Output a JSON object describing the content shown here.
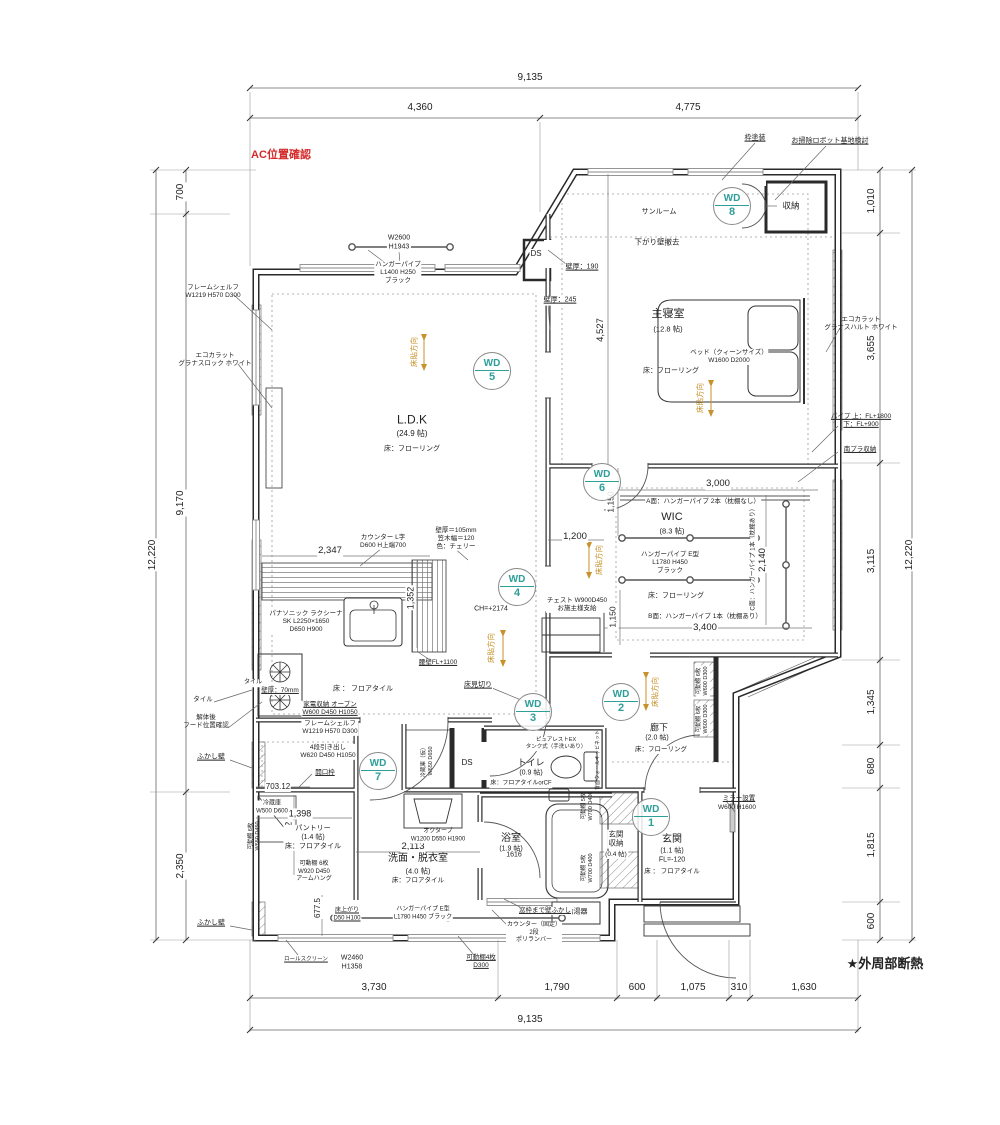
{
  "colors": {
    "red": "#d42a2a",
    "orange": "#c8922a",
    "teal": "#2e9e99",
    "line": "#2a2a2a"
  },
  "notes": {
    "ac_check": "AC位置確認",
    "insulation": "★外周部断熱"
  },
  "rooms": [
    {
      "name": "LDK",
      "label": "L.D.K",
      "size": "(24.9 帖)",
      "floor": "床：フローリング"
    },
    {
      "name": "主寝室",
      "label": "主寝室",
      "size": "(12.8 帖)",
      "floor": "床：フローリング"
    },
    {
      "name": "WIC",
      "label": "WIC",
      "size": "(8.3 帖)",
      "floor": "床：フローリング"
    },
    {
      "name": "廊下",
      "label": "廊下",
      "size": "(2.0 帖)",
      "floor": "床：フローリング"
    },
    {
      "name": "トイレ",
      "label": "トイレ",
      "size": "(0.9 帖)",
      "floor": "床：フロアタイルorCF"
    },
    {
      "name": "浴室",
      "label": "浴室",
      "size": "(1.9 帖)",
      "floor": "1616"
    },
    {
      "name": "洗面・脱衣室",
      "label": "洗面・脱衣室",
      "size": "(4.0 帖)",
      "floor": "床：フロアタイル"
    },
    {
      "name": "パントリー",
      "label": "パントリー",
      "size": "(1.4 帖)",
      "floor": "床：フロアタイル"
    },
    {
      "name": "玄関",
      "label": "玄関",
      "size": "(1.1 帖)",
      "floor": "床：フロアタイル"
    },
    {
      "name": "玄関収納",
      "label": "玄関収納",
      "size": "(0.4 帖)"
    },
    {
      "name": "サンルーム",
      "label": "サンルーム"
    }
  ],
  "wd_markers": [
    {
      "n": "wd-1",
      "label": "WD",
      "num": "1",
      "x": 651,
      "y": 817
    },
    {
      "n": "wd-2",
      "label": "WD",
      "num": "2",
      "x": 621,
      "y": 702
    },
    {
      "n": "wd-3",
      "label": "WD",
      "num": "3",
      "x": 533,
      "y": 712
    },
    {
      "n": "wd-4",
      "label": "WD",
      "num": "4",
      "x": 517,
      "y": 587
    },
    {
      "n": "wd-5",
      "label": "WD",
      "num": "5",
      "x": 492,
      "y": 371
    },
    {
      "n": "wd-6",
      "label": "WD",
      "num": "6",
      "x": 602,
      "y": 482
    },
    {
      "n": "wd-7",
      "label": "WD",
      "num": "7",
      "x": 378,
      "y": 771
    },
    {
      "n": "wd-8",
      "label": "WD",
      "num": "8",
      "x": 732,
      "y": 206
    }
  ],
  "labels": [
    {
      "n": "note-ac-check",
      "t": "AC位置確認",
      "x": 281,
      "y": 156,
      "s": 11,
      "c": "r",
      "w": 1
    },
    {
      "n": "note-insulation",
      "t": "★外周部断熱",
      "x": 885,
      "y": 964,
      "s": 13,
      "w": 1
    },
    {
      "n": "dim-top-total",
      "t": "9,135",
      "x": 530,
      "y": 78,
      "s": 10,
      "bg": 1
    },
    {
      "n": "dim-top-left",
      "t": "4,360",
      "x": 420,
      "y": 108,
      "s": 10,
      "bg": 1
    },
    {
      "n": "dim-top-right",
      "t": "4,775",
      "x": 688,
      "y": 108,
      "s": 10,
      "bg": 1
    },
    {
      "n": "dim-bottom-1",
      "t": "3,730",
      "x": 374,
      "y": 988,
      "s": 10,
      "bg": 1
    },
    {
      "n": "dim-bottom-2",
      "t": "1,790",
      "x": 557,
      "y": 988,
      "s": 10,
      "bg": 1
    },
    {
      "n": "dim-bottom-3",
      "t": "600",
      "x": 637,
      "y": 988,
      "s": 10,
      "bg": 1
    },
    {
      "n": "dim-bottom-4",
      "t": "1,075",
      "x": 693,
      "y": 988,
      "s": 10,
      "bg": 1
    },
    {
      "n": "dim-bottom-5",
      "t": "310",
      "x": 739,
      "y": 988,
      "s": 10,
      "bg": 1
    },
    {
      "n": "dim-bottom-6",
      "t": "1,630",
      "x": 804,
      "y": 988,
      "s": 10,
      "bg": 1
    },
    {
      "n": "dim-bottom-total",
      "t": "9,135",
      "x": 530,
      "y": 1020,
      "s": 10,
      "bg": 1
    },
    {
      "n": "dim-left-700",
      "t": "700",
      "x": 181,
      "y": 192,
      "s": 10,
      "r": -90,
      "bg": 1
    },
    {
      "n": "dim-left-9170",
      "t": "9,170",
      "x": 181,
      "y": 503,
      "s": 10,
      "r": -90,
      "bg": 1
    },
    {
      "n": "dim-left-2350",
      "t": "2,350",
      "x": 181,
      "y": 866,
      "s": 10,
      "r": -90,
      "bg": 1
    },
    {
      "n": "dim-left-total",
      "t": "12,220",
      "x": 153,
      "y": 555,
      "s": 10,
      "r": -90,
      "bg": 1
    },
    {
      "n": "dim-right-1010",
      "t": "1,010",
      "x": 872,
      "y": 201,
      "s": 10,
      "r": -90,
      "bg": 1
    },
    {
      "n": "dim-right-3655",
      "t": "3,655",
      "x": 872,
      "y": 348,
      "s": 10,
      "r": -90,
      "bg": 1
    },
    {
      "n": "dim-right-3115",
      "t": "3,115",
      "x": 872,
      "y": 561,
      "s": 10,
      "r": -90,
      "bg": 1
    },
    {
      "n": "dim-right-1345",
      "t": "1,345",
      "x": 872,
      "y": 702,
      "s": 10,
      "r": -90,
      "bg": 1
    },
    {
      "n": "dim-right-680",
      "t": "680",
      "x": 872,
      "y": 766,
      "s": 10,
      "r": -90,
      "bg": 1
    },
    {
      "n": "dim-right-1815",
      "t": "1,815",
      "x": 872,
      "y": 845,
      "s": 10,
      "r": -90,
      "bg": 1
    },
    {
      "n": "dim-right-600",
      "t": "600",
      "x": 872,
      "y": 921,
      "s": 10,
      "r": -90,
      "bg": 1
    },
    {
      "n": "dim-right-total",
      "t": "12,220",
      "x": 910,
      "y": 555,
      "s": 10,
      "r": -90,
      "bg": 1
    },
    {
      "n": "dim-4527",
      "t": "4,527",
      "x": 601,
      "y": 330,
      "s": 9.5,
      "r": -90,
      "bg": 1
    },
    {
      "n": "dim-3000",
      "t": "3,000",
      "x": 718,
      "y": 484,
      "s": 9.5,
      "bg": 1
    },
    {
      "n": "dim-2140",
      "t": "2,140",
      "x": 763,
      "y": 560,
      "s": 9.5,
      "r": -90,
      "bg": 1
    },
    {
      "n": "dim-3400",
      "t": "3,400",
      "x": 705,
      "y": 628,
      "s": 9.5,
      "bg": 1
    },
    {
      "n": "dim-1150-a",
      "t": "1,150",
      "x": 611,
      "y": 502,
      "s": 8.5,
      "r": -90,
      "bg": 1
    },
    {
      "n": "dim-1150-b",
      "t": "1,150",
      "x": 613,
      "y": 617,
      "s": 8.5,
      "r": -90,
      "bg": 1
    },
    {
      "n": "dim-1200",
      "t": "1,200",
      "x": 575,
      "y": 537,
      "s": 9.5,
      "bg": 1
    },
    {
      "n": "dim-2347",
      "t": "2,347",
      "x": 330,
      "y": 551,
      "s": 9.5,
      "bg": 1
    },
    {
      "n": "dim-1352",
      "t": "1,352",
      "x": 411,
      "y": 598,
      "s": 9,
      "r": -90,
      "bg": 1
    },
    {
      "n": "dim-2113",
      "t": "2,113",
      "x": 413,
      "y": 847,
      "s": 9.5,
      "bg": 1
    },
    {
      "n": "dim-1398",
      "t": "1,398",
      "x": 300,
      "y": 814,
      "s": 9,
      "bg": 1
    },
    {
      "n": "dim-1442",
      "t": "1,442",
      "x": 289,
      "y": 833,
      "s": 9,
      "r": -90,
      "bg": 1
    },
    {
      "n": "dim-703",
      "t": "703.12",
      "x": 278,
      "y": 787,
      "s": 8,
      "bg": 1
    },
    {
      "n": "dim-677",
      "t": "677.5",
      "x": 318,
      "y": 908,
      "s": 8,
      "r": -90,
      "bg": 1
    },
    {
      "n": "dim-1616",
      "t": "1616",
      "x": 514,
      "y": 856,
      "s": 7,
      "bg": 1
    },
    {
      "n": "note-frame-paint",
      "t": "枠塗装",
      "x": 755,
      "y": 139,
      "s": 7,
      "u": 1
    },
    {
      "n": "note-robot-base",
      "t": "お掃除ロボット基地検討",
      "x": 830,
      "y": 142,
      "s": 7,
      "u": 1
    },
    {
      "n": "label-closet-tr",
      "t": "収納",
      "x": 791,
      "y": 206,
      "s": 8.5,
      "bg": 1
    },
    {
      "n": "label-sunroom",
      "t": "サンルーム",
      "x": 659,
      "y": 213,
      "s": 7
    },
    {
      "n": "note-drop-wall-remove",
      "t": "下がり壁撤去",
      "x": 657,
      "y": 242,
      "s": 7.5
    },
    {
      "n": "label-window-w2600",
      "t": "W2600\nH1943",
      "x": 399,
      "y": 243,
      "s": 7,
      "bg": 1
    },
    {
      "n": "note-wall-190",
      "t": "壁厚：190",
      "x": 582,
      "y": 268,
      "s": 7,
      "u": 1,
      "bg": 1
    },
    {
      "n": "note-wall-245",
      "t": "壁厚：245",
      "x": 560,
      "y": 301,
      "s": 7,
      "u": 1,
      "bg": 1
    },
    {
      "n": "label-ds-top",
      "t": "DS",
      "x": 536,
      "y": 254,
      "s": 8,
      "bg": 1
    },
    {
      "n": "label-hanger-ldk",
      "t": "ハンガーパイプ\nL1400 H250\nブラック",
      "x": 398,
      "y": 273,
      "s": 6.5,
      "bg": 1
    },
    {
      "n": "label-frame-shelf-top",
      "t": "フレームシェルフ\nW1219  H570  D300",
      "x": 213,
      "y": 292,
      "s": 6.5
    },
    {
      "n": "label-ecocarat-left",
      "t": "エコカラット\nグラナスロック  ホワイト",
      "x": 215,
      "y": 360,
      "s": 6.5
    },
    {
      "n": "room-bedroom",
      "t": "主寝室",
      "x": 668,
      "y": 315,
      "s": 11
    },
    {
      "n": "room-bedroom-size",
      "t": "(12.8 帖)",
      "x": 668,
      "y": 329,
      "s": 7.5
    },
    {
      "n": "label-bed",
      "t": "ベッド（クィーンサイズ）\nW1600  D2000",
      "x": 729,
      "y": 357,
      "s": 6.5,
      "bg": 1
    },
    {
      "n": "room-bedroom-floor",
      "t": "床：フローリング",
      "x": 671,
      "y": 372,
      "s": 7
    },
    {
      "n": "dir-bedroom",
      "t": "床貼方向",
      "x": 700,
      "y": 398,
      "s": 7.5,
      "r": -90,
      "c": "o"
    },
    {
      "n": "label-ecocarat-right",
      "t": "エコカラット\nグラナスハルト  ホワイト",
      "x": 861,
      "y": 324,
      "s": 6.5
    },
    {
      "n": "note-pipe-right",
      "t": "パイプ 上：FL+1800\n下：FL+900",
      "x": 861,
      "y": 421,
      "s": 6.5,
      "u": 1
    },
    {
      "n": "note-south-storage",
      "t": "南プラ収納",
      "x": 860,
      "y": 450,
      "s": 6.5,
      "u": 1
    },
    {
      "n": "room-ldk",
      "t": "L.D.K",
      "x": 412,
      "y": 420,
      "s": 12
    },
    {
      "n": "room-ldk-size",
      "t": "(24.9 帖)",
      "x": 412,
      "y": 434,
      "s": 8
    },
    {
      "n": "room-ldk-floor",
      "t": "床：フローリング",
      "x": 412,
      "y": 450,
      "s": 7
    },
    {
      "n": "dir-ldk",
      "t": "床貼方向",
      "x": 414,
      "y": 352,
      "s": 7.5,
      "r": -90,
      "c": "o"
    },
    {
      "n": "room-wic",
      "t": "WIC",
      "x": 672,
      "y": 518,
      "s": 11,
      "bg": 1
    },
    {
      "n": "room-wic-size",
      "t": "(8.3 帖)",
      "x": 672,
      "y": 531,
      "s": 7.5,
      "bg": 1
    },
    {
      "n": "label-wic-a",
      "t": "A面：ハンガーパイプ 2本（枕棚なし）",
      "x": 703,
      "y": 502,
      "s": 6.5,
      "bg": 1
    },
    {
      "n": "label-wic-pipe",
      "t": "ハンガーパイプ  E型\nL1780  H450\nブラック",
      "x": 670,
      "y": 563,
      "s": 6.5,
      "bg": 1
    },
    {
      "n": "room-wic-floor",
      "t": "床：フローリング",
      "x": 676,
      "y": 597,
      "s": 7,
      "bg": 1
    },
    {
      "n": "label-wic-b",
      "t": "B面：ハンガーパイプ 1本（枕棚あり）",
      "x": 705,
      "y": 617,
      "s": 6.5,
      "bg": 1
    },
    {
      "n": "label-wic-c",
      "t": "C面：ハンガーパイプ 1本（枕棚あり）",
      "x": 754,
      "y": 558,
      "s": 6,
      "r": -90,
      "bg": 1
    },
    {
      "n": "dir-wic",
      "t": "床貼方向",
      "x": 599,
      "y": 560,
      "s": 7.5,
      "r": -90,
      "c": "o"
    },
    {
      "n": "label-chest",
      "t": "チェスト  W900D450\nお施主様支給",
      "x": 577,
      "y": 605,
      "s": 6.5,
      "bg": 1
    },
    {
      "n": "note-ch",
      "t": "CH=+2174",
      "x": 491,
      "y": 610,
      "s": 7
    },
    {
      "n": "dir-kitchen",
      "t": "床貼方向",
      "x": 491,
      "y": 648,
      "s": 7.5,
      "r": -90,
      "c": "o"
    },
    {
      "n": "note-wall-105",
      "t": "壁厚＝105mm\n笠木幅＝120\n色：チェリー",
      "x": 456,
      "y": 539,
      "s": 6.5,
      "bg": 1
    },
    {
      "n": "label-counter-l",
      "t": "カウンター  L字\nD600  H上端700",
      "x": 383,
      "y": 542,
      "s": 6.5,
      "bg": 1
    },
    {
      "n": "label-kitchen-sk",
      "t": "パナソニック  ラクシーナ\nSK  L2250×1650\nD650  H900",
      "x": 306,
      "y": 622,
      "s": 6.5,
      "bg": 1
    },
    {
      "n": "note-koshikabe",
      "t": "腰壁FL+1100",
      "x": 438,
      "y": 663,
      "s": 6.5,
      "u": 1,
      "bg": 1
    },
    {
      "n": "note-floor-joint",
      "t": "床見切り",
      "x": 478,
      "y": 686,
      "s": 7,
      "u": 1,
      "bg": 1
    },
    {
      "n": "note-tile-small",
      "t": "タイル",
      "x": 253,
      "y": 683,
      "s": 6,
      "bg": 1
    },
    {
      "n": "note-wall-70",
      "t": "壁厚：70mm",
      "x": 280,
      "y": 691,
      "s": 6.5,
      "u": 1,
      "bg": 1
    },
    {
      "n": "label-kitchen-floor",
      "t": "床 ： フロアタイル",
      "x": 363,
      "y": 690,
      "s": 7,
      "bg": 1
    },
    {
      "n": "label-kaden",
      "t": "家電収納  オープン\nW600  D450  H1050",
      "x": 330,
      "y": 709,
      "s": 6.5,
      "u": 1,
      "bg": 1
    },
    {
      "n": "label-frame-shelf-low",
      "t": "フレームシェルフ\nW1219  H570  D300",
      "x": 330,
      "y": 728,
      "s": 6.5,
      "bg": 1
    },
    {
      "n": "label-drawers",
      "t": "4段引き出し\nW620  D450  H1050",
      "x": 328,
      "y": 752,
      "s": 6.5,
      "bg": 1
    },
    {
      "n": "note-opening-frame",
      "t": "開口枠",
      "x": 325,
      "y": 773,
      "s": 6.5,
      "u": 1,
      "bg": 1
    },
    {
      "n": "note-tile-left",
      "t": "タイル",
      "x": 203,
      "y": 700,
      "s": 6.5
    },
    {
      "n": "note-hood-check",
      "t": "解体後\nフード位置確認",
      "x": 206,
      "y": 722,
      "s": 6.5
    },
    {
      "n": "note-fukashi-1",
      "t": "ふかし壁",
      "x": 211,
      "y": 758,
      "s": 7,
      "u": 1
    },
    {
      "n": "note-fukashi-2",
      "t": "ふかし壁",
      "x": 211,
      "y": 924,
      "s": 7,
      "u": 1
    },
    {
      "n": "label-fridge",
      "t": "冷蔵庫\nW500  D600",
      "x": 272,
      "y": 808,
      "s": 6,
      "bg": 1
    },
    {
      "n": "room-pantry",
      "t": "パントリー\n(1.4 帖)\n床：フロアタイル",
      "x": 313,
      "y": 838,
      "s": 7,
      "bg": 1
    },
    {
      "n": "label-shelf-pantry-w",
      "t": "可動棚 6枚\nW650 D450",
      "x": 255,
      "y": 836,
      "s": 5.5,
      "r": -90
    },
    {
      "n": "label-shelf-pantry-s",
      "t": "可動棚 6枚\nW920 D450\nアームハング",
      "x": 314,
      "y": 872,
      "s": 6,
      "bg": 1
    },
    {
      "n": "label-fridge-temp",
      "t": "冷蔵庫（仮）\nW650 D650",
      "x": 428,
      "y": 761,
      "s": 5.5,
      "r": -90
    },
    {
      "n": "label-ds-mid",
      "t": "DS",
      "x": 467,
      "y": 763,
      "s": 8
    },
    {
      "n": "room-toilet",
      "t": "トイレ",
      "x": 531,
      "y": 763,
      "s": 9
    },
    {
      "n": "room-toilet-size",
      "t": "(0.9 帖)",
      "x": 531,
      "y": 774,
      "s": 7
    },
    {
      "n": "room-toilet-floor",
      "t": "床：フロアタイルorCF",
      "x": 521,
      "y": 784,
      "s": 6,
      "bg": 1
    },
    {
      "n": "label-purerest",
      "t": "ピュアレストEX\nタンク式（手洗いあり）",
      "x": 556,
      "y": 744,
      "s": 5.5,
      "bg": 1
    },
    {
      "n": "label-wall-cabinet",
      "t": "背面ウォールキャビネット",
      "x": 598,
      "y": 760,
      "s": 5,
      "r": -90
    },
    {
      "n": "room-senmen",
      "t": "洗面・脱衣室",
      "x": 418,
      "y": 859,
      "s": 10
    },
    {
      "n": "room-senmen-size",
      "t": "(4.0 帖)",
      "x": 418,
      "y": 871,
      "s": 7.5
    },
    {
      "n": "room-senmen-floor",
      "t": "床：フロアタイル",
      "x": 418,
      "y": 881,
      "s": 6.5
    },
    {
      "n": "label-octave",
      "t": "オクターブ\nW1200  D550  H1900",
      "x": 438,
      "y": 836,
      "s": 6,
      "bg": 1
    },
    {
      "n": "room-bath",
      "t": "浴室",
      "x": 511,
      "y": 839,
      "s": 10
    },
    {
      "n": "room-bath-size",
      "t": "(1.9 帖)",
      "x": 511,
      "y": 850,
      "s": 7
    },
    {
      "n": "room-genkan-storage",
      "t": "玄関\n収納",
      "x": 616,
      "y": 839,
      "s": 7.5,
      "bg": 1
    },
    {
      "n": "room-genkan-storage-size",
      "t": "(0.4 帖)",
      "x": 616,
      "y": 855,
      "s": 6.5,
      "bg": 1
    },
    {
      "n": "label-shelf-gs-1",
      "t": "可動棚 5枚\nW700 D400",
      "x": 588,
      "y": 806,
      "s": 5.5,
      "r": -90
    },
    {
      "n": "label-shelf-gs-2",
      "t": "可動棚 5枚\nW700 D400",
      "x": 588,
      "y": 868,
      "s": 5.5,
      "r": -90
    },
    {
      "n": "room-genkan",
      "t": "玄関",
      "x": 672,
      "y": 840,
      "s": 10
    },
    {
      "n": "room-genkan-size",
      "t": "(1.1 帖)",
      "x": 672,
      "y": 852,
      "s": 7
    },
    {
      "n": "room-genkan-fl",
      "t": "FL=-120",
      "x": 672,
      "y": 861,
      "s": 7
    },
    {
      "n": "room-genkan-floor",
      "t": "床 ： フロアタイル",
      "x": 672,
      "y": 872,
      "s": 6.5
    },
    {
      "n": "note-mirror",
      "t": "ミラー設置",
      "x": 739,
      "y": 799,
      "s": 6.5,
      "u": 1
    },
    {
      "n": "note-mirror-size",
      "t": "W600  H1600",
      "x": 737,
      "y": 808,
      "s": 6.5
    },
    {
      "n": "room-hall",
      "t": "廊下",
      "x": 659,
      "y": 728,
      "s": 9,
      "bg": 1
    },
    {
      "n": "room-hall-size",
      "t": "(2.0 帖)",
      "x": 657,
      "y": 739,
      "s": 7,
      "bg": 1
    },
    {
      "n": "room-hall-floor",
      "t": "床：フローリング",
      "x": 661,
      "y": 750,
      "s": 6.5,
      "bg": 1
    },
    {
      "n": "label-shelf-hall-1",
      "t": "可動棚 6枚\nW600 D300",
      "x": 703,
      "y": 681,
      "s": 5.5,
      "r": -90,
      "bg": 1
    },
    {
      "n": "label-shelf-hall-2",
      "t": "可動棚 6枚\nW600 D300",
      "x": 703,
      "y": 719,
      "s": 5.5,
      "r": -90,
      "bg": 1
    },
    {
      "n": "dir-hall",
      "t": "床貼方向",
      "x": 655,
      "y": 692,
      "s": 7.5,
      "r": -90,
      "c": "o"
    },
    {
      "n": "label-water-heater",
      "t": "給湯器",
      "x": 577,
      "y": 913,
      "s": 7
    },
    {
      "n": "note-window-fukashi",
      "t": "窓枠まで壁ふかし",
      "x": 545,
      "y": 911,
      "s": 6.5,
      "u": 1,
      "bg": 1
    },
    {
      "n": "label-counter-fixed",
      "t": "カウンター（固定）\n2段\nポリランバー",
      "x": 534,
      "y": 933,
      "s": 6,
      "bg": 1
    },
    {
      "n": "label-shelf-4",
      "t": "可動棚4枚\nD300",
      "x": 481,
      "y": 962,
      "s": 6.5,
      "u": 1,
      "bg": 1
    },
    {
      "n": "label-window-w2460",
      "t": "W2460\nH1358",
      "x": 352,
      "y": 963,
      "s": 7,
      "bg": 1
    },
    {
      "n": "note-roll-screen",
      "t": "ロールスクリーン",
      "x": 306,
      "y": 960,
      "s": 5.5,
      "u": 1,
      "bg": 1
    },
    {
      "n": "note-floor-raise",
      "t": "床上がり\nD50 H100",
      "x": 347,
      "y": 915,
      "s": 6,
      "u": 1,
      "bg": 1
    },
    {
      "n": "label-hanger-south",
      "t": "ハンガーパイプ  E型\nL1780  H450  ブラック",
      "x": 423,
      "y": 914,
      "s": 6,
      "bg": 1
    }
  ]
}
